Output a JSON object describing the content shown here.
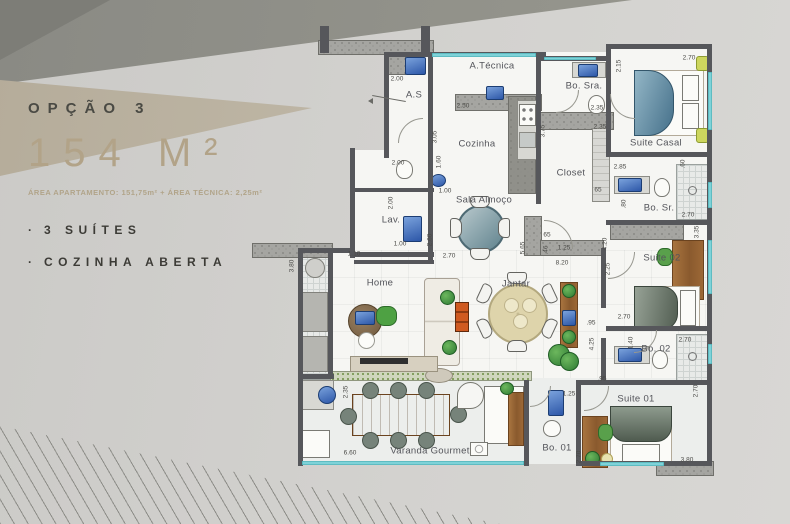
{
  "panel": {
    "option_label": "OPÇÃO 3",
    "area_value": "154 M²",
    "area_detail": "ÁREA APARTAMENTO: 151,75m² + ÁREA TÉCNICA: 2,25m²",
    "bullet": "·",
    "features": [
      "3 SUÍTES",
      "COZINHA ABERTA"
    ],
    "colors": {
      "accent_tan": "#b2a388",
      "text_dark": "#3c3b36"
    }
  },
  "plan": {
    "colors": {
      "wall": "#56575b",
      "concrete": "#a5a5a1",
      "floor": "#f6f6f3",
      "window_glass": "#7ed2d8",
      "fixture_blue": "#2d57a8",
      "wood": "#8a5a2e",
      "plant_green": "#2e7a33"
    },
    "rooms": [
      {
        "id": "a-tecnica",
        "label": "A.Técnica",
        "x": 492,
        "y": 66
      },
      {
        "id": "as",
        "label": "A.S",
        "x": 414,
        "y": 95
      },
      {
        "id": "cozinha",
        "label": "Cozinha",
        "x": 477,
        "y": 144
      },
      {
        "id": "bo-sra",
        "label": "Bo. Sra.",
        "x": 584,
        "y": 86
      },
      {
        "id": "suite-casal",
        "label": "Suite Casal",
        "x": 656,
        "y": 143
      },
      {
        "id": "closet",
        "label": "Closet",
        "x": 571,
        "y": 173
      },
      {
        "id": "sala-almoco",
        "label": "Sala Almoço",
        "x": 484,
        "y": 200
      },
      {
        "id": "lav",
        "label": "Lav.",
        "x": 391,
        "y": 220
      },
      {
        "id": "home",
        "label": "Home",
        "x": 380,
        "y": 283
      },
      {
        "id": "jantar",
        "label": "Jantar",
        "x": 516,
        "y": 284
      },
      {
        "id": "bo-sr",
        "label": "Bo. Sr.",
        "x": 659,
        "y": 208
      },
      {
        "id": "suite-02",
        "label": "Suite 02",
        "x": 662,
        "y": 258
      },
      {
        "id": "bo-02",
        "label": "Bo. 02",
        "x": 656,
        "y": 349
      },
      {
        "id": "suite-01",
        "label": "Suite 01",
        "x": 636,
        "y": 399
      },
      {
        "id": "bo-01",
        "label": "Bo. 01",
        "x": 557,
        "y": 448
      },
      {
        "id": "varanda",
        "label": "Varanda Gourmet",
        "x": 430,
        "y": 451
      }
    ],
    "dims": [
      {
        "t": "2.00",
        "x": 397,
        "y": 79,
        "r": 0
      },
      {
        "t": "2.50",
        "x": 463,
        "y": 106,
        "r": 0
      },
      {
        "t": "3.05",
        "x": 435,
        "y": 137,
        "r": -90
      },
      {
        "t": "1.60",
        "x": 439,
        "y": 162,
        "r": -90
      },
      {
        "t": "2.00",
        "x": 398,
        "y": 163,
        "r": 0
      },
      {
        "t": "2.00",
        "x": 391,
        "y": 203,
        "r": -90
      },
      {
        "t": "1.00",
        "x": 400,
        "y": 244,
        "r": 0
      },
      {
        "t": "1.00",
        "x": 445,
        "y": 191,
        "r": 0
      },
      {
        "t": "2.60",
        "x": 430,
        "y": 240,
        "r": -90
      },
      {
        "t": "2.70",
        "x": 449,
        "y": 256,
        "r": 0
      },
      {
        "t": "1.10",
        "x": 354,
        "y": 254,
        "r": 0
      },
      {
        "t": "3.80",
        "x": 292,
        "y": 266,
        "r": -90
      },
      {
        "t": "2.35",
        "x": 597,
        "y": 108,
        "r": 0
      },
      {
        "t": "2.35",
        "x": 600,
        "y": 127,
        "r": 0
      },
      {
        "t": "3.75",
        "x": 543,
        "y": 131,
        "r": -90
      },
      {
        "t": "2.70",
        "x": 689,
        "y": 58,
        "r": 0
      },
      {
        "t": "2.15",
        "x": 619,
        "y": 66,
        "r": -90
      },
      {
        "t": "2.85",
        "x": 620,
        "y": 167,
        "r": 0
      },
      {
        "t": ".60",
        "x": 683,
        "y": 164,
        "r": -90
      },
      {
        "t": "65",
        "x": 598,
        "y": 190,
        "r": 0
      },
      {
        "t": "65",
        "x": 547,
        "y": 235,
        "r": 0
      },
      {
        "t": ".46",
        "x": 546,
        "y": 250,
        "r": -90
      },
      {
        "t": "1.25",
        "x": 564,
        "y": 248,
        "r": 0
      },
      {
        "t": "8.20",
        "x": 562,
        "y": 263,
        "r": 0
      },
      {
        "t": "5.65",
        "x": 523,
        "y": 248,
        "r": -90
      },
      {
        "t": "4.20",
        "x": 605,
        "y": 244,
        "r": -90
      },
      {
        "t": "2.25",
        "x": 608,
        "y": 269,
        "r": -90
      },
      {
        "t": "2.70",
        "x": 688,
        "y": 215,
        "r": 0
      },
      {
        "t": ".80",
        "x": 624,
        "y": 204,
        "r": -90
      },
      {
        "t": "3.35",
        "x": 697,
        "y": 232,
        "r": -90
      },
      {
        "t": "2.70",
        "x": 624,
        "y": 317,
        "r": 0
      },
      {
        "t": ".95",
        "x": 591,
        "y": 323,
        "r": 0
      },
      {
        "t": "4.25",
        "x": 592,
        "y": 344,
        "r": -90
      },
      {
        "t": "2.70",
        "x": 685,
        "y": 340,
        "r": 0
      },
      {
        "t": "1.40",
        "x": 631,
        "y": 343,
        "r": -90
      },
      {
        "t": ".95",
        "x": 602,
        "y": 379,
        "r": 0
      },
      {
        "t": "1.25",
        "x": 569,
        "y": 394,
        "r": 0
      },
      {
        "t": "2.70",
        "x": 696,
        "y": 391,
        "r": -90
      },
      {
        "t": "3.80",
        "x": 687,
        "y": 460,
        "r": 0
      },
      {
        "t": "2.70",
        "x": 579,
        "y": 457,
        "r": -90
      },
      {
        "t": "2.35",
        "x": 346,
        "y": 392,
        "r": -90
      },
      {
        "t": "6.60",
        "x": 350,
        "y": 453,
        "r": 0
      }
    ]
  }
}
